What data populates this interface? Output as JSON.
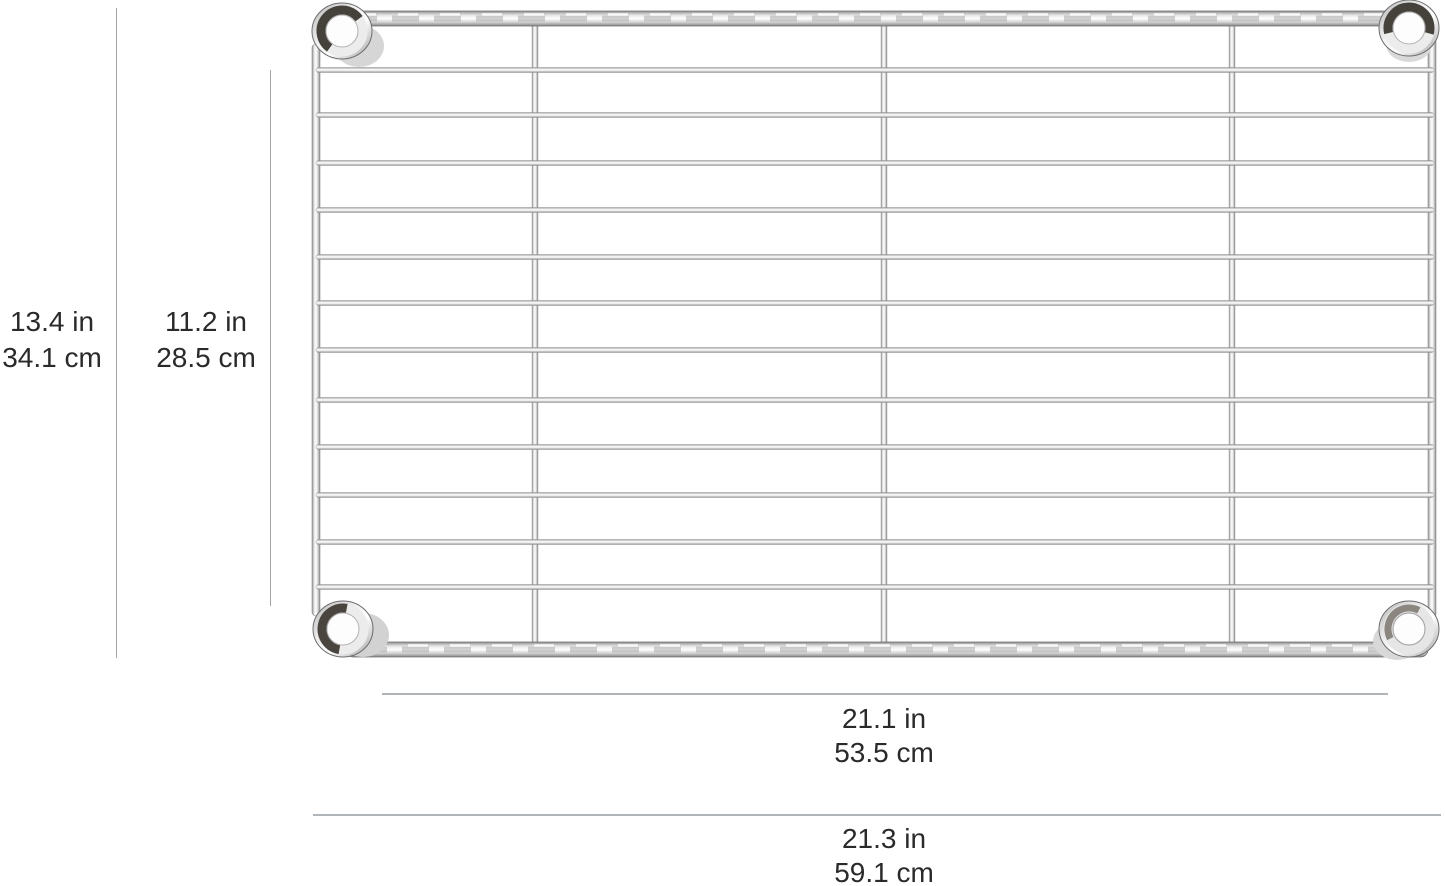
{
  "image": {
    "name": "chrome-wire-shelf-dimension-diagram"
  },
  "dimensions": {
    "depth_outer": {
      "in": "13.4 in",
      "cm": "34.1 cm"
    },
    "depth_inner": {
      "in": "11.2 in",
      "cm": "28.5 cm"
    },
    "width_inner": {
      "in": "21.1 in",
      "cm": "53.5 cm"
    },
    "width_outer": {
      "in": "21.3 in",
      "cm": "59.1 cm"
    }
  },
  "colors": {
    "background": "#ffffff",
    "text": "#2a2a2a",
    "dimension_line": "#b2b5b8",
    "chrome_light": "#f5f5f5",
    "chrome_mid": "#c6c6c6",
    "chrome_dark": "#7c7c7c",
    "collar_rim_dark": "#45413b"
  }
}
